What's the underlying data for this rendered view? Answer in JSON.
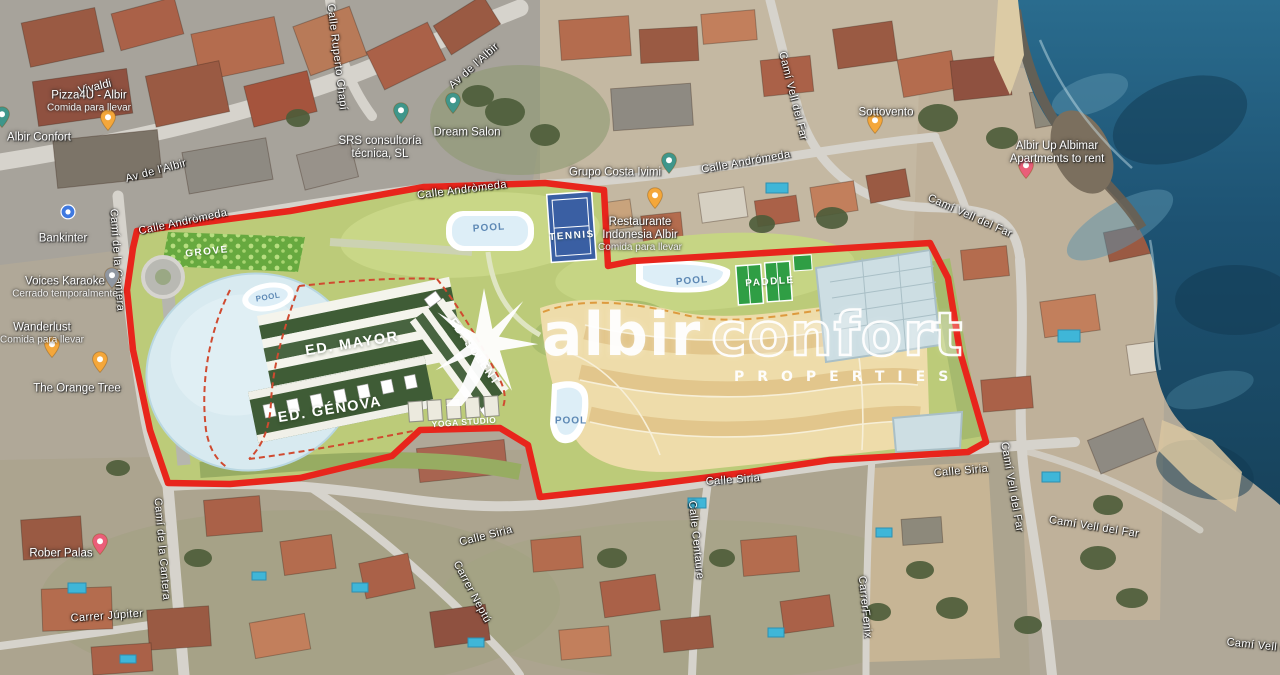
{
  "watermark": {
    "brand_solid": "albir",
    "brand_outline": "confort",
    "subtitle": "PROPERTIES",
    "icon": "palm-star-icon"
  },
  "colors": {
    "boundary_red": "#e8251c",
    "plan_green": "#bccb79",
    "lake_blue": "#d8eaf0",
    "tan_zone": "#eedcaa",
    "tennis_blue": "#3a5fa3",
    "paddle_green": "#2f9e44",
    "pool_text_blue": "#5d88b4",
    "sea_blue": "#1d5272",
    "pin_restaurant": "#F4A73B",
    "pin_business": "#3F968B",
    "pin_bar": "#9097A1",
    "pin_lodging": "#EA5E79",
    "pin_bank": "#3F79E0"
  },
  "plan_labels": [
    {
      "name": "grove",
      "label": "GROVE",
      "x": 207,
      "y": 252,
      "rot": -6,
      "style": "white-small"
    },
    {
      "name": "pool-north",
      "label": "POOL",
      "x": 489,
      "y": 228,
      "rot": -4,
      "style": "pool"
    },
    {
      "name": "tennis",
      "label": "TENNIS",
      "x": 572,
      "y": 236,
      "rot": -4,
      "style": "white-small"
    },
    {
      "name": "pool-lake",
      "label": "POOL",
      "x": 268,
      "y": 297,
      "rot": -10,
      "style": "pool-tiny"
    },
    {
      "name": "pool-center",
      "label": "POOL",
      "x": 692,
      "y": 281,
      "rot": -5,
      "style": "pool"
    },
    {
      "name": "paddle",
      "label": "PADDLE",
      "x": 770,
      "y": 282,
      "rot": -4,
      "style": "white-small"
    },
    {
      "name": "pool-south",
      "label": "POOL",
      "x": 571,
      "y": 421,
      "rot": 0,
      "style": "pool"
    },
    {
      "name": "ed-mayor",
      "label": "ED. MAYOR",
      "x": 352,
      "y": 344,
      "rot": -9,
      "style": "building"
    },
    {
      "name": "ed-genova",
      "label": "ED. GÉNOVA",
      "x": 330,
      "y": 410,
      "rot": -9,
      "style": "building"
    },
    {
      "name": "ed-solent",
      "label": "ED. SOLENT",
      "x": 474,
      "y": 352,
      "rot": 55,
      "style": "building-small"
    },
    {
      "name": "yoga-studio",
      "label": "YOGA STUDIO",
      "x": 464,
      "y": 422,
      "rot": -4,
      "style": "white-tiny"
    }
  ],
  "street_labels": [
    {
      "name": "av-albir-west",
      "label": "Av de l'Albir",
      "x": 156,
      "y": 171,
      "rot": -15
    },
    {
      "name": "av-albir-north",
      "label": "Av de l'Albir",
      "x": 474,
      "y": 66,
      "rot": -42
    },
    {
      "name": "calle-ruperto-chapi",
      "label": "Calle Ruperto Chapí",
      "x": 337,
      "y": 57,
      "rot": 83
    },
    {
      "name": "calle-andromeda-west",
      "label": "Calle Andròmeda",
      "x": 183,
      "y": 222,
      "rot": -12
    },
    {
      "name": "calle-andromeda-mid",
      "label": "Calle Andròmeda",
      "x": 462,
      "y": 190,
      "rot": -7
    },
    {
      "name": "calle-andromeda-east",
      "label": "Calle Andrómeda",
      "x": 746,
      "y": 162,
      "rot": -10
    },
    {
      "name": "cami-cantera-north",
      "label": "Camí de la Cantera",
      "x": 117,
      "y": 260,
      "rot": 86
    },
    {
      "name": "cami-vell-far-north",
      "label": "Camí Vell del Far",
      "x": 793,
      "y": 96,
      "rot": 76
    },
    {
      "name": "cami-vell-far-ne",
      "label": "Camí Vell del Far",
      "x": 970,
      "y": 216,
      "rot": 24
    },
    {
      "name": "calle-siria-west",
      "label": "Calle Siria",
      "x": 486,
      "y": 536,
      "rot": -14
    },
    {
      "name": "calle-siria-mid",
      "label": "Calle Siria",
      "x": 733,
      "y": 480,
      "rot": -4
    },
    {
      "name": "calle-siria-east",
      "label": "Calle Siria",
      "x": 961,
      "y": 471,
      "rot": -5
    },
    {
      "name": "carrer-neptu",
      "label": "Carrer Neptú",
      "x": 472,
      "y": 592,
      "rot": 62
    },
    {
      "name": "calle-centaure",
      "label": "Calle Centaure",
      "x": 696,
      "y": 540,
      "rot": 84
    },
    {
      "name": "cami-vell-far-east",
      "label": "Camí Vell del Far",
      "x": 1012,
      "y": 487,
      "rot": 80
    },
    {
      "name": "cami-vell-far-se",
      "label": "Camí Vell del Far",
      "x": 1094,
      "y": 527,
      "rot": 9
    },
    {
      "name": "carrer-fenix",
      "label": "CarrerFenix",
      "x": 865,
      "y": 607,
      "rot": 84
    },
    {
      "name": "carrer-jupiter",
      "label": "Carrer Júpiter",
      "x": 107,
      "y": 616,
      "rot": -4
    },
    {
      "name": "cami-cantera-south",
      "label": "Camí de la Cantera",
      "x": 162,
      "y": 549,
      "rot": 85
    },
    {
      "name": "cami-vell-far-corner",
      "label": "Camí Vell del Far",
      "x": 1272,
      "y": 647,
      "rot": 6
    }
  ],
  "pois": [
    {
      "name": "vivaldi",
      "pin": null,
      "rot": -14,
      "lx": 95,
      "ly": 88,
      "lines": [
        {
          "t": "Vivaldi",
          "cls": "poi-name"
        }
      ]
    },
    {
      "name": "pizza4u-albir",
      "pin": {
        "type": "restaurant",
        "x": 108,
        "y": 133
      },
      "lx": 89,
      "ly": 102,
      "lines": [
        {
          "t": "Pizza4U - Albir",
          "cls": "poi-name"
        },
        {
          "t": "Comida para llevar",
          "cls": "poi-sub"
        }
      ]
    },
    {
      "name": "albir-confort",
      "pin": {
        "type": "business",
        "x": 2,
        "y": 130
      },
      "lx": 39,
      "ly": 138,
      "lines": [
        {
          "t": "Albir Confort",
          "cls": "poi-name"
        }
      ]
    },
    {
      "name": "bankinter",
      "pin": {
        "type": "bank",
        "x": 68,
        "y": 222
      },
      "lx": 63,
      "ly": 239,
      "lines": [
        {
          "t": "Bankinter",
          "cls": "poi-name"
        }
      ]
    },
    {
      "name": "voices-karaoke",
      "pin": {
        "type": "bar",
        "x": 112,
        "y": 291
      },
      "lx": 65,
      "ly": 288,
      "lines": [
        {
          "t": "Voices Karaoke",
          "cls": "poi-name"
        },
        {
          "t": "Cerrado temporalmente",
          "cls": "poi-sub"
        }
      ]
    },
    {
      "name": "wanderlust",
      "pin": {
        "type": "restaurant",
        "x": 52,
        "y": 360
      },
      "lx": 42,
      "ly": 334,
      "lines": [
        {
          "t": "Wanderlust",
          "cls": "poi-name"
        },
        {
          "t": "Comida para llevar",
          "cls": "poi-sub"
        }
      ]
    },
    {
      "name": "the-orange-tree",
      "pin": {
        "type": "restaurant",
        "x": 100,
        "y": 375
      },
      "lx": 77,
      "ly": 389,
      "lines": [
        {
          "t": "The Orange Tree",
          "cls": "poi-name"
        }
      ]
    },
    {
      "name": "rober-palas",
      "pin": {
        "type": "lodging",
        "x": 100,
        "y": 557
      },
      "lx": 61,
      "ly": 554,
      "lines": [
        {
          "t": "Rober Palas",
          "cls": "poi-name"
        }
      ]
    },
    {
      "name": "srs-consultoria",
      "pin": {
        "type": "business",
        "x": 401,
        "y": 126
      },
      "lx": 380,
      "ly": 148,
      "lines": [
        {
          "t": "SRS consultoría",
          "cls": "poi-name"
        },
        {
          "t": "técnica, SL",
          "cls": "poi-name"
        }
      ]
    },
    {
      "name": "dream-salon",
      "pin": {
        "type": "business",
        "x": 453,
        "y": 116
      },
      "lx": 467,
      "ly": 133,
      "lines": [
        {
          "t": "Dream Salon",
          "cls": "poi-name"
        }
      ]
    },
    {
      "name": "grupo-costa-ivimi",
      "pin": {
        "type": "business",
        "x": 669,
        "y": 176
      },
      "lx": 615,
      "ly": 173,
      "lines": [
        {
          "t": "Grupo Costa Ivimi",
          "cls": "poi-name"
        }
      ]
    },
    {
      "name": "restaurante-indonesia-albir",
      "pin": {
        "type": "restaurant",
        "x": 655,
        "y": 211
      },
      "lx": 640,
      "ly": 235,
      "lines": [
        {
          "t": "Restaurante",
          "cls": "poi-name"
        },
        {
          "t": "Indonesia Albir",
          "cls": "poi-name"
        },
        {
          "t": "Comida para llevar",
          "cls": "poi-sub"
        }
      ]
    },
    {
      "name": "sottovento",
      "pin": {
        "type": "restaurant",
        "x": 875,
        "y": 136
      },
      "lx": 886,
      "ly": 113,
      "lines": [
        {
          "t": "Sottovento",
          "cls": "poi-name"
        }
      ]
    },
    {
      "name": "albir-up-albimar",
      "pin": {
        "type": "lodging",
        "x": 1026,
        "y": 181
      },
      "lx": 1057,
      "ly": 153,
      "lines": [
        {
          "t": "Albir Up Albimar",
          "cls": "poi-name"
        },
        {
          "t": "Apartments to rent",
          "cls": "poi-name"
        }
      ]
    }
  ]
}
